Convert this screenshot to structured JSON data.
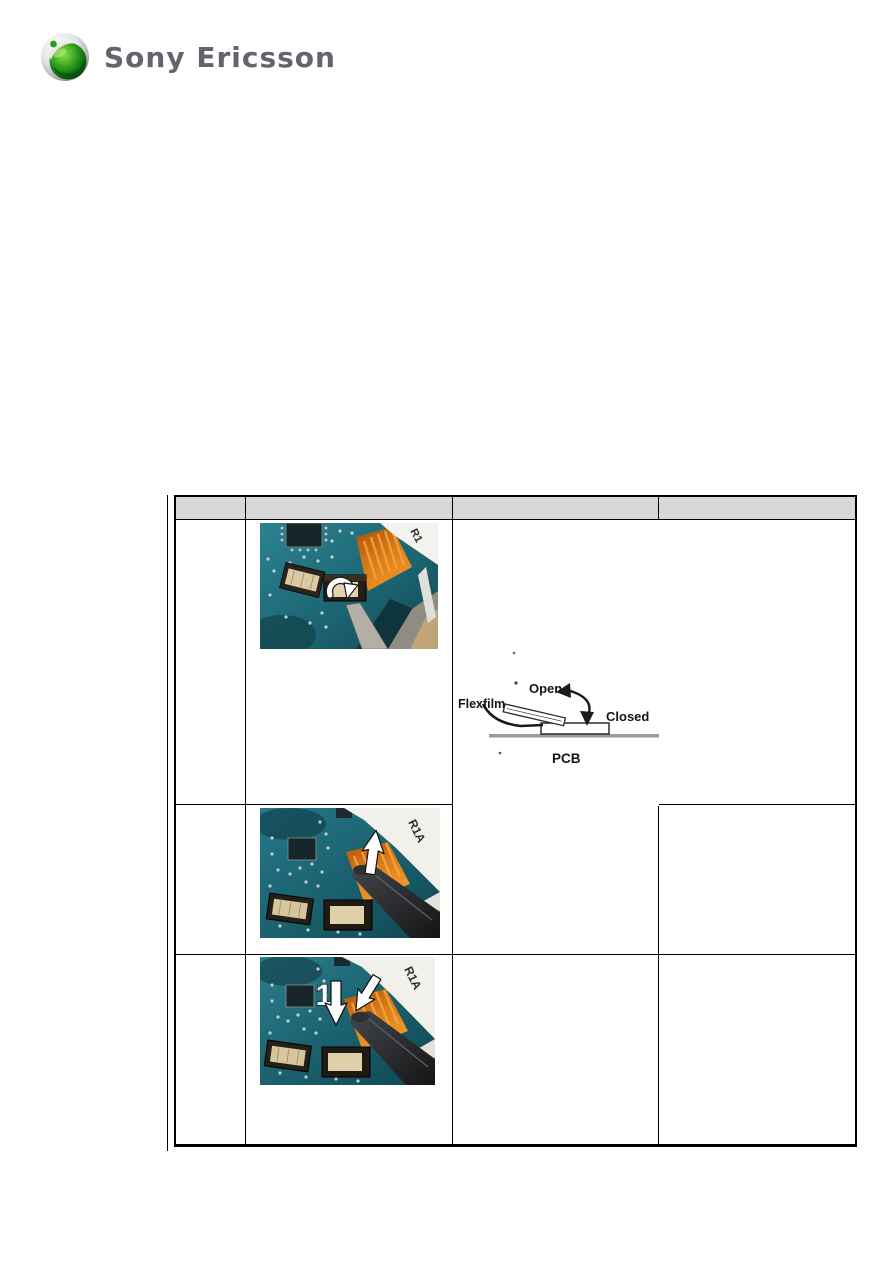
{
  "logo": {
    "brand": "Sony Ericsson"
  },
  "table": {
    "headers": [
      "",
      "",
      "",
      ""
    ],
    "rows": [
      {
        "photo_label": "R1",
        "diagram": {
          "flexfilm": "Flexfilm",
          "open": "Open",
          "closed": "Closed",
          "pcb": "PCB"
        }
      },
      {
        "photo_label": "R1A"
      },
      {
        "photo_label": "R1A",
        "step_number": "1"
      }
    ]
  },
  "colors": {
    "header_fill": "#d8d8d8",
    "table_border": "#000000",
    "pcb_teal": "#1e6b78",
    "flex_orange": "#d97c18",
    "logo_text_gray": "#63646e",
    "logo_green": "#2c9a22"
  }
}
